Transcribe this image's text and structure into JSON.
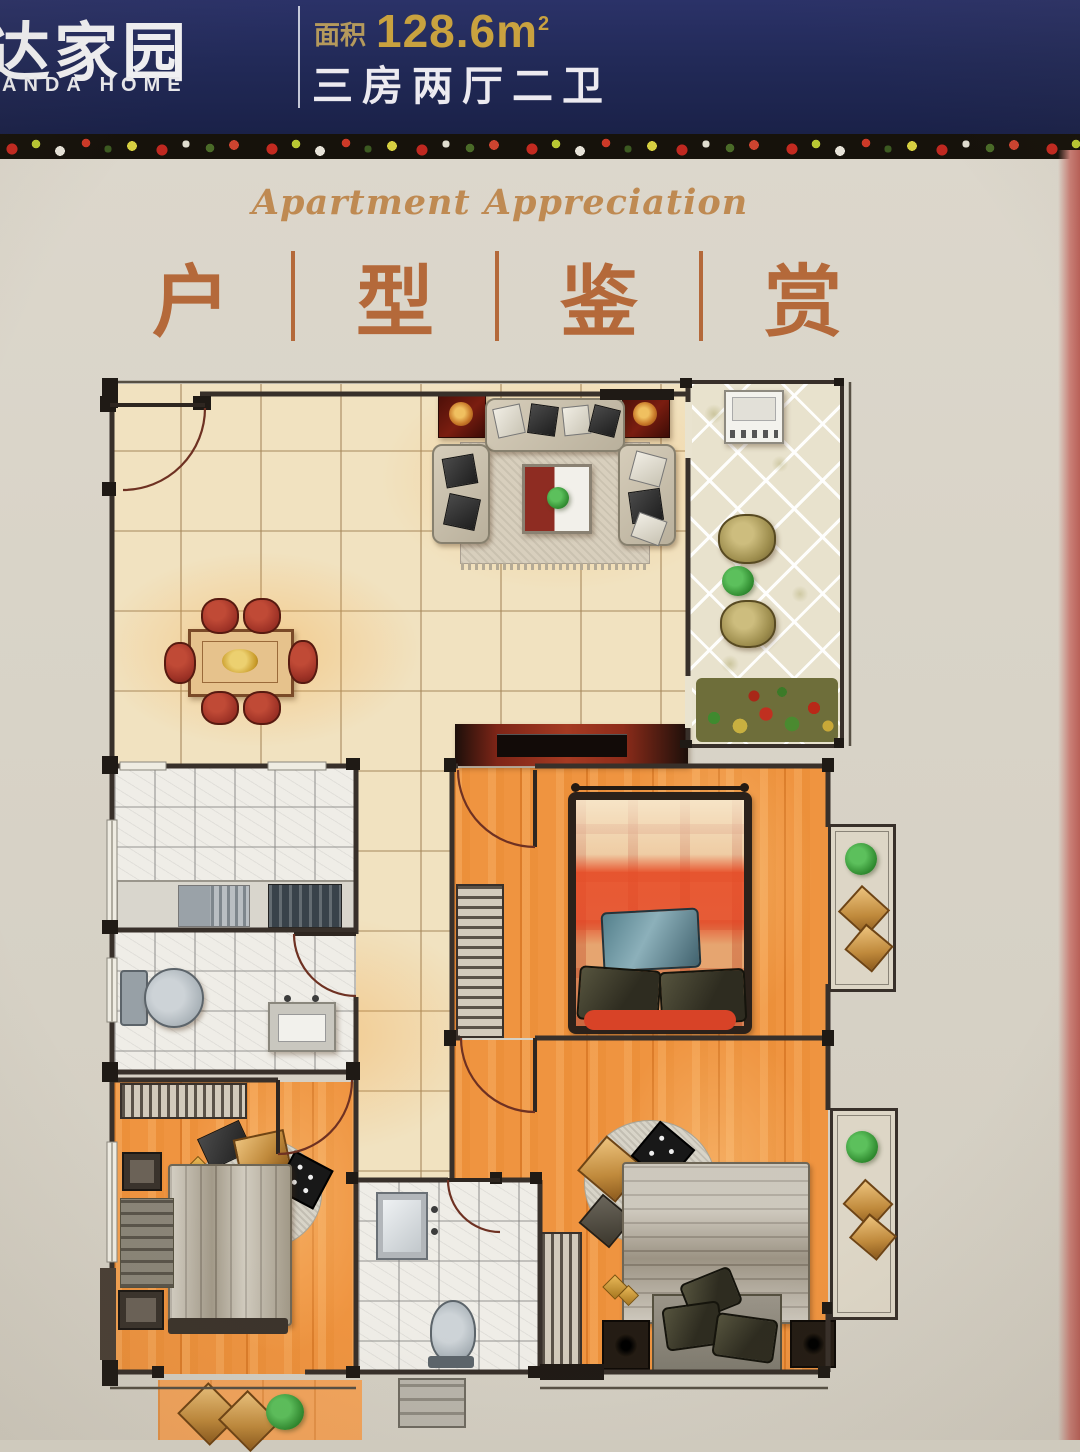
{
  "header": {
    "logo_cn": "达家园",
    "logo_en": "ANDA HOME",
    "area_label": "面积",
    "area_value": "128.6m",
    "area_sup": "2",
    "layout_text": "三房两厅二卫"
  },
  "hero": {
    "caption_en": "Apartment Appreciation",
    "title_chars": [
      "户",
      "型",
      "鉴",
      "赏"
    ],
    "separator": "|"
  },
  "floor_plan": {
    "rooms": [
      "living-dining-room",
      "balcony",
      "kitchen",
      "bathroom",
      "master-bedroom",
      "second-bedroom",
      "second-bathroom",
      "third-bedroom",
      "rear-balcony"
    ]
  },
  "colors": {
    "header_bg": "#222a58",
    "header_gold": "#c9a23f",
    "title_copper": "#b4693a",
    "floor_orange": "#ef9440",
    "tile_cream": "#f1e2c0",
    "wall_dark": "#38302a",
    "tv_wall_red": "#8e2c1a"
  }
}
